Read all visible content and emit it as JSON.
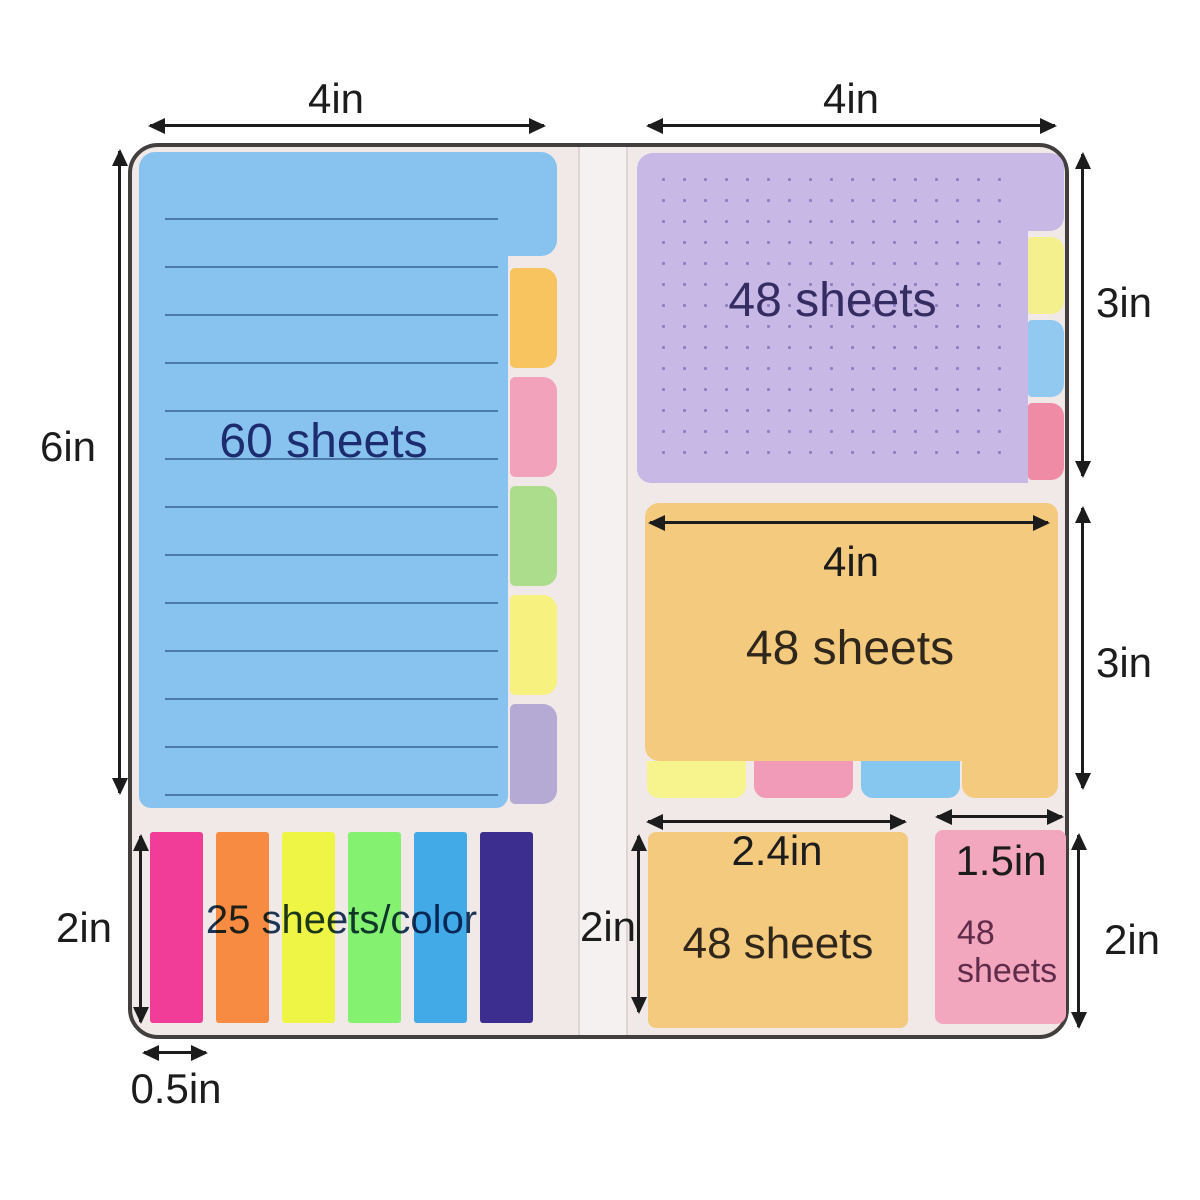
{
  "dimensions": {
    "blue_pad_width": "4in",
    "blue_pad_height": "6in",
    "purple_pad_width": "4in",
    "purple_pad_height": "3in",
    "orange_pad_width": "4in",
    "orange_pad_height": "3in",
    "flags_height": "2in",
    "flag_width": "0.5in",
    "small_orange_width": "2.4in",
    "small_orange_height": "2in",
    "small_pink_width": "1.5in",
    "small_pink_height": "2in"
  },
  "pads": {
    "blue": {
      "label": "60 sheets"
    },
    "purple": {
      "label": "48 sheets"
    },
    "orange": {
      "label": "48 sheets"
    },
    "small_orange": {
      "label": "48 sheets"
    },
    "small_pink": {
      "line1": "48",
      "line2": "sheets"
    },
    "flags": {
      "label": "25 sheets/color"
    }
  },
  "colors": {
    "folder_bg": "#f0e9e8",
    "folder_border": "#433f3f",
    "arrow": "#1c1c1c",
    "blue_pad": "#88c3ef",
    "blue_pad_text": "#1d2c6e",
    "blue_tabs": [
      "#f7c45f",
      "#f2a3bb",
      "#acdd8c",
      "#f7f180",
      "#b5aad3"
    ],
    "purple_pad": "#c7b8e5",
    "purple_pad_dots": "#8f80c1",
    "purple_pad_text": "#352c62",
    "purple_tabs": [
      "#f5f08e",
      "#91c9f0",
      "#f08ba5"
    ],
    "orange_pad": "#f4ca7e",
    "orange_pad_text": "#2f271b",
    "orange_tabs": [
      "#f7f38d",
      "#f19bb9",
      "#86c7f0"
    ],
    "small_pink_pad": "#f3a7bf",
    "small_pink_text": "#602c4a",
    "flags": [
      "#f13d97",
      "#f78b41",
      "#eff545",
      "#84f171",
      "#42aae7",
      "#3c2e8e"
    ],
    "flags_text": "#1d3a5c"
  }
}
